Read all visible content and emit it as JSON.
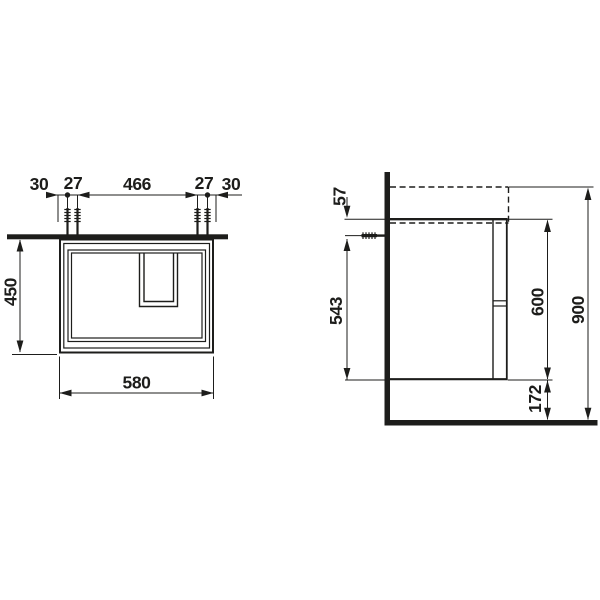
{
  "drawing": {
    "front_view": {
      "dim_30_left": "30",
      "dim_27_left": "27",
      "dim_466": "466",
      "dim_27_right": "27",
      "dim_30_right": "30",
      "dim_450": "450",
      "dim_580": "580"
    },
    "side_view": {
      "dim_57": "57",
      "dim_543": "543",
      "dim_600": "600",
      "dim_900": "900",
      "dim_172": "172"
    },
    "colors": {
      "line": "#1d1d1b",
      "background": "#ffffff"
    }
  }
}
